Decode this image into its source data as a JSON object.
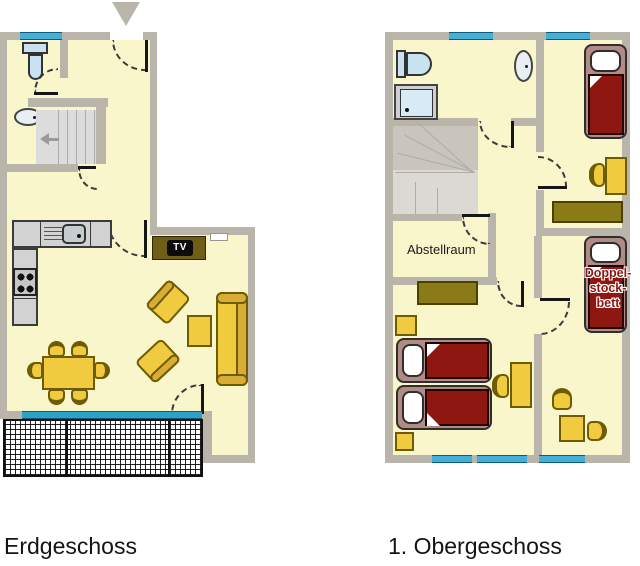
{
  "colors": {
    "wall": "#BAB5AA",
    "floor": "#FAF6CC",
    "window": "#45AFD8",
    "slider": "#2BA3C8",
    "furniture": "#F0CB3F",
    "furniture-dark": "#D9AC33",
    "outline": "#6E5C04",
    "olive": "#8A7B16",
    "tvboard": "#6F5F16",
    "bedframe": "#B28B85",
    "bedred": "#8E1711",
    "stairs": "#DCDCDC",
    "landing": "#C9C5BC",
    "fixture": "#C9E2F2",
    "counter": "#D2D2D2"
  },
  "floors": {
    "ground": {
      "label": "Erdgeschoss",
      "tv_label": "TV"
    },
    "upper": {
      "label": "1. Obergeschoss",
      "storage_label": "Abstellraum",
      "bunk_label_lines": [
        "Doppel-",
        "stock-",
        "bett"
      ]
    }
  }
}
